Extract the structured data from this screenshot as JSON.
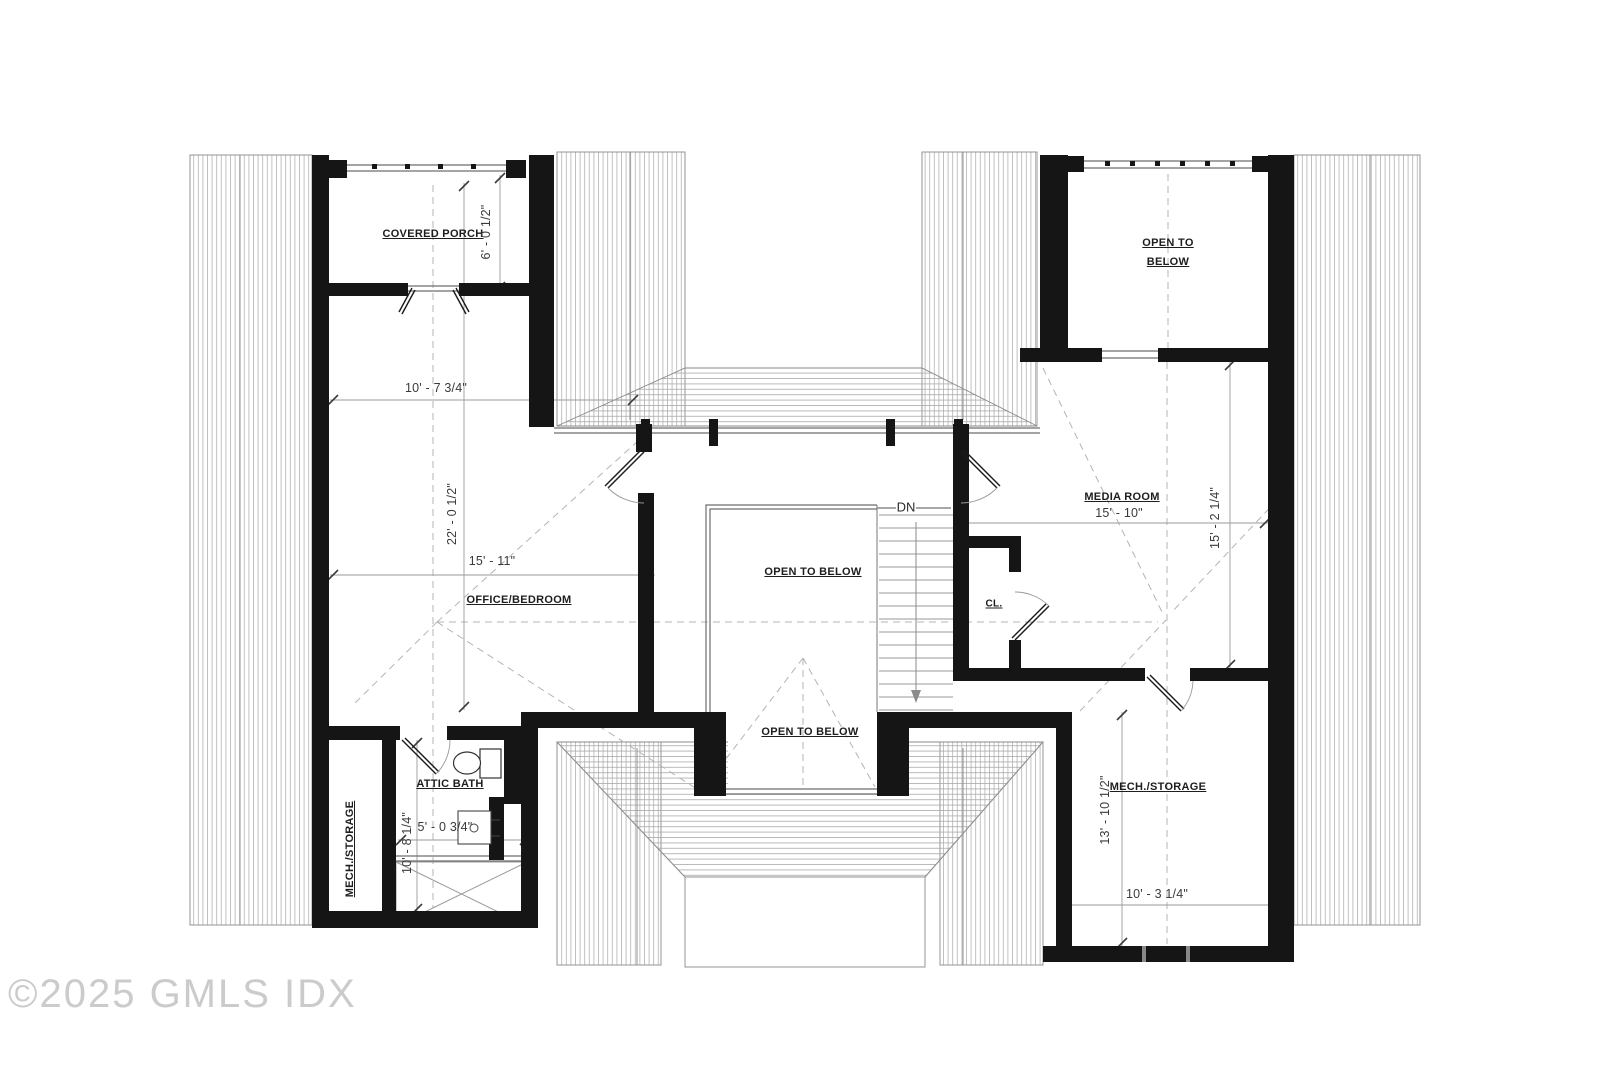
{
  "plan": {
    "rooms": {
      "covered_porch": "COVERED PORCH",
      "office_bedroom": "OFFICE/BEDROOM",
      "media_room": "MEDIA ROOM",
      "attic_bath": "ATTIC BATH",
      "closet": "CL.",
      "mech_storage_left": "MECH./STORAGE",
      "mech_storage_right": "MECH./STORAGE",
      "open_to_below_center": "OPEN TO BELOW",
      "open_to_below_bottom": "OPEN TO BELOW",
      "open_to_below_upper_line1": "OPEN TO",
      "open_to_below_upper_line2": "BELOW"
    },
    "dimensions": {
      "porch_depth": "6' - 0 1/2\"",
      "office_width": "10' - 7 3/4\"",
      "office_length": "22' - 0 1/2\"",
      "office_width_inner": "15' - 11\"",
      "media_width": "15' - 10\"",
      "media_depth": "15' - 2 1/4\"",
      "bath_width": "5' - 0 3/4\"",
      "bath_length": "10' - 8 1/4\"",
      "storage_length": "13' - 10 1/2\"",
      "storage_width": "10' - 3 1/4\""
    },
    "stairs": {
      "direction": "DN"
    },
    "watermark": "©2025 GMLS IDX"
  }
}
